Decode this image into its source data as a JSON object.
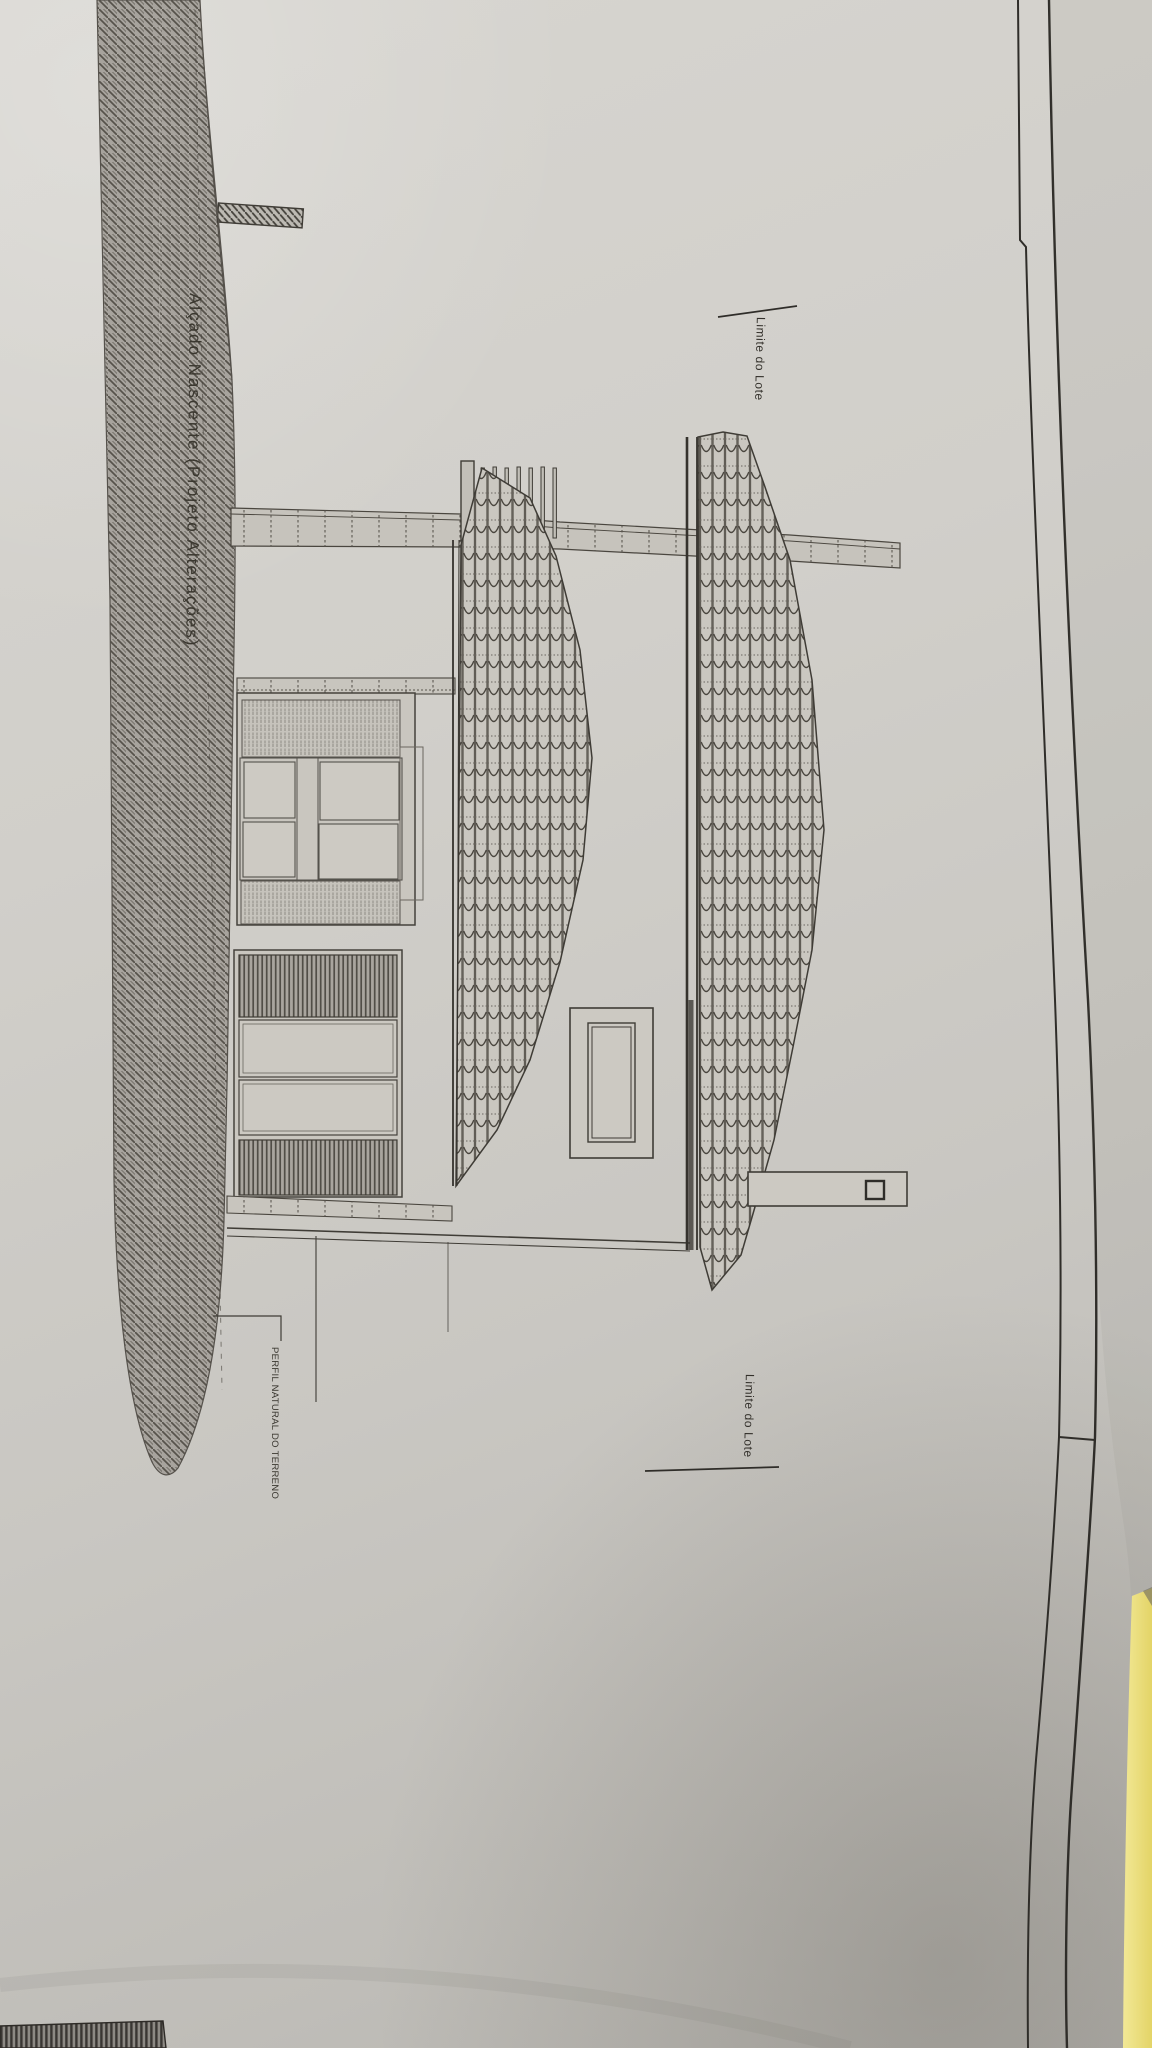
{
  "drawing": {
    "title": "Alçado Nascente (Projeto Alterações)",
    "labels": {
      "lot_boundary_top": "Limite do Lote",
      "lot_boundary_bottom": "Limite do Lote",
      "terrain_profile": "PERFIL NATURAL DO TERRENO"
    },
    "colors": {
      "paper": "#d2d0cb",
      "ink": "#3a3731",
      "terrain_hatch_field": "#a7a39d",
      "terrain_hatch_line": "#56524b",
      "folder_yellow": "#ede285",
      "background_shadow": "#b3b1ac"
    }
  }
}
